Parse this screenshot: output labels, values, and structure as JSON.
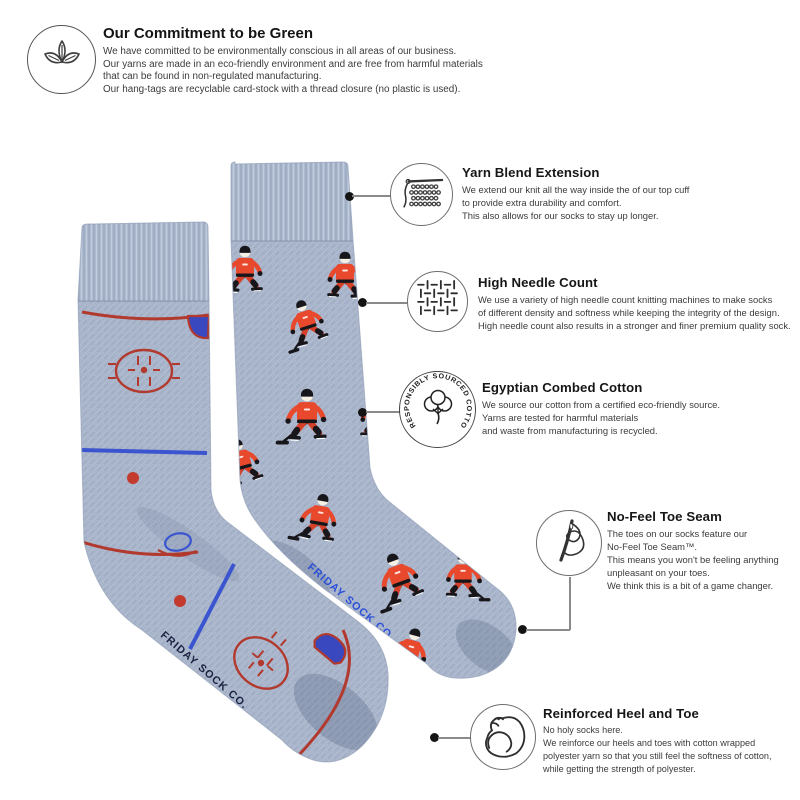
{
  "colors": {
    "sock_base": "#a7b3c9",
    "rink_red": "#b2392d",
    "rink_blue": "#3a55cf",
    "jersey_orange": "#e8482c",
    "brand_navy": "#1b2240",
    "brand_blue": "#2b4fd8"
  },
  "green_commitment": {
    "icon": "leaf-sprout-icon",
    "title": "Our Commitment to be Green",
    "body": "We have committed to be environmentally conscious in all areas of our business.\nOur yarns are made in an eco-friendly environment and are free from harmful materials\nthat can be found in non-regulated manufacturing.\nOur hang-tags are recyclable card-stock with a thread closure (no plastic is used)."
  },
  "callouts": [
    {
      "icon": "knitting-yarn-icon",
      "title": "Yarn Blend Extension",
      "body": "We extend our knit all the way inside the of our top cuff\nto provide extra durability and comfort.\nThis also allows for our socks to stay up longer."
    },
    {
      "icon": "knit-stitch-grid-icon",
      "title": "High Needle Count",
      "body": "We use a variety of high needle count knitting machines to make socks\nof different density and softness while keeping the integrity of the design.\nHigh needle count also results in a stronger and finer premium quality sock."
    },
    {
      "icon": "cotton-boll-badge-icon",
      "badge_text": "RESPONSIBLY SOURCED COTTON",
      "title": "Egyptian Combed Cotton",
      "body": "We source our cotton from a certified eco-friendly source.\nYarns are tested for harmful materials\nand waste from manufacturing is recycled."
    },
    {
      "icon": "needle-thread-icon",
      "title": "No-Feel Toe Seam",
      "body": "The toes on our socks feature our\nNo-Feel Toe Seam™.\nThis means you won't be feeling anything\nunpleasant on your toes.\nWe think this is a bit of a game changer."
    },
    {
      "icon": "flexed-bicep-icon",
      "title": "Reinforced Heel and Toe",
      "body": "No holy socks here.\nWe reinforce our heels and toes with cotton wrapped\npolyester yarn so that you still feel the softness of cotton,\nwhile getting the strength of polyester."
    }
  ],
  "socks": {
    "brand_text": "FRIDAY SOCK CO."
  }
}
